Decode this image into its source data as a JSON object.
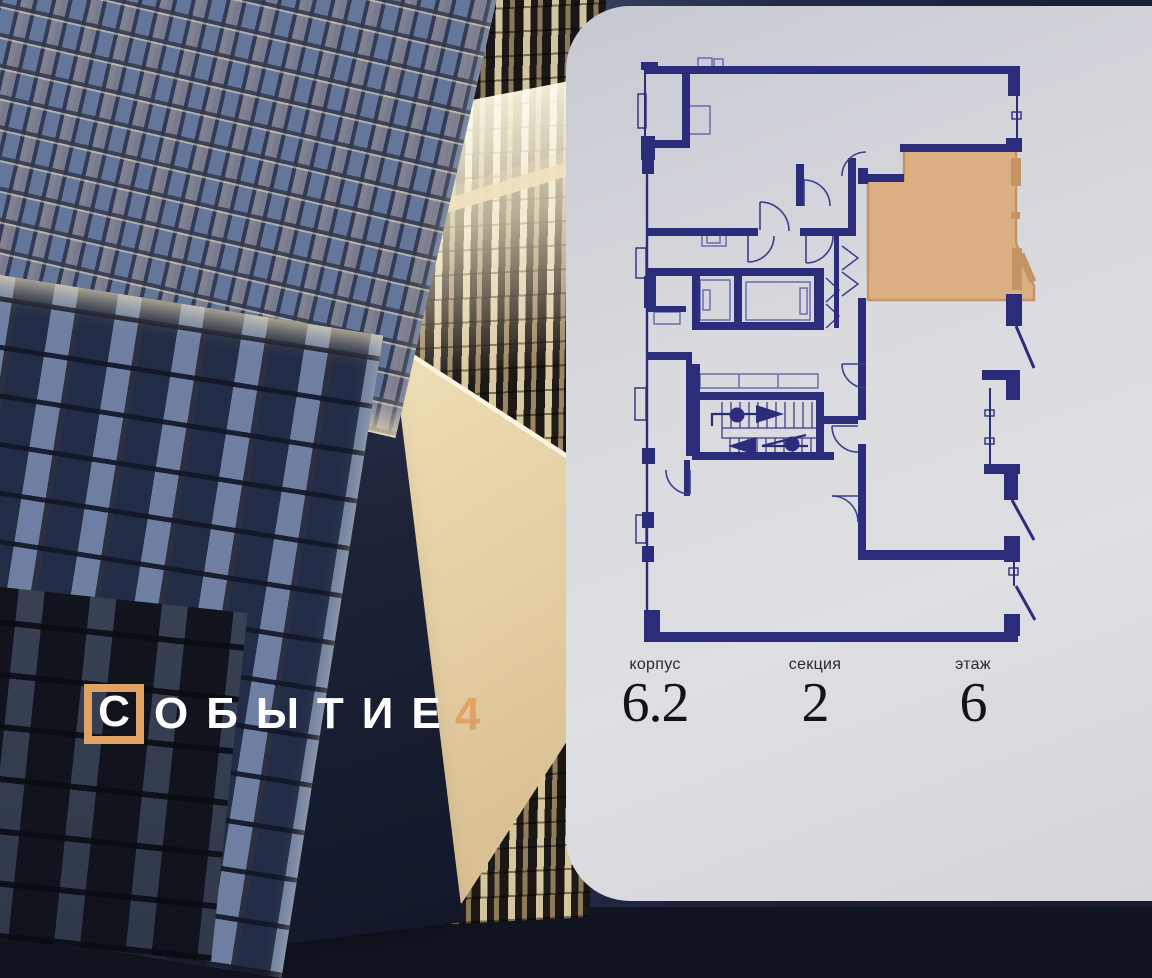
{
  "brand": {
    "letter_boxed": "С",
    "letters_rest": "ОБЫТИЕ",
    "number": "4",
    "accent_color": "#E0A363",
    "text_color": "#FFFFFF"
  },
  "scene": {
    "description": "night render of residential towers with lit windows",
    "sky_color": "#1C2240",
    "warm_light_color": "#F2E3C0"
  },
  "floorplan_panel": {
    "background": "#DADBE0",
    "wall_color": "#2B2D7B",
    "highlight": {
      "name": "selected-apartment",
      "fill": "#DCAF83",
      "border": "#C49465"
    },
    "stats": [
      {
        "label": "корпус",
        "value": "6.2"
      },
      {
        "label": "секция",
        "value": "2"
      },
      {
        "label": "этаж",
        "value": "6"
      }
    ]
  }
}
